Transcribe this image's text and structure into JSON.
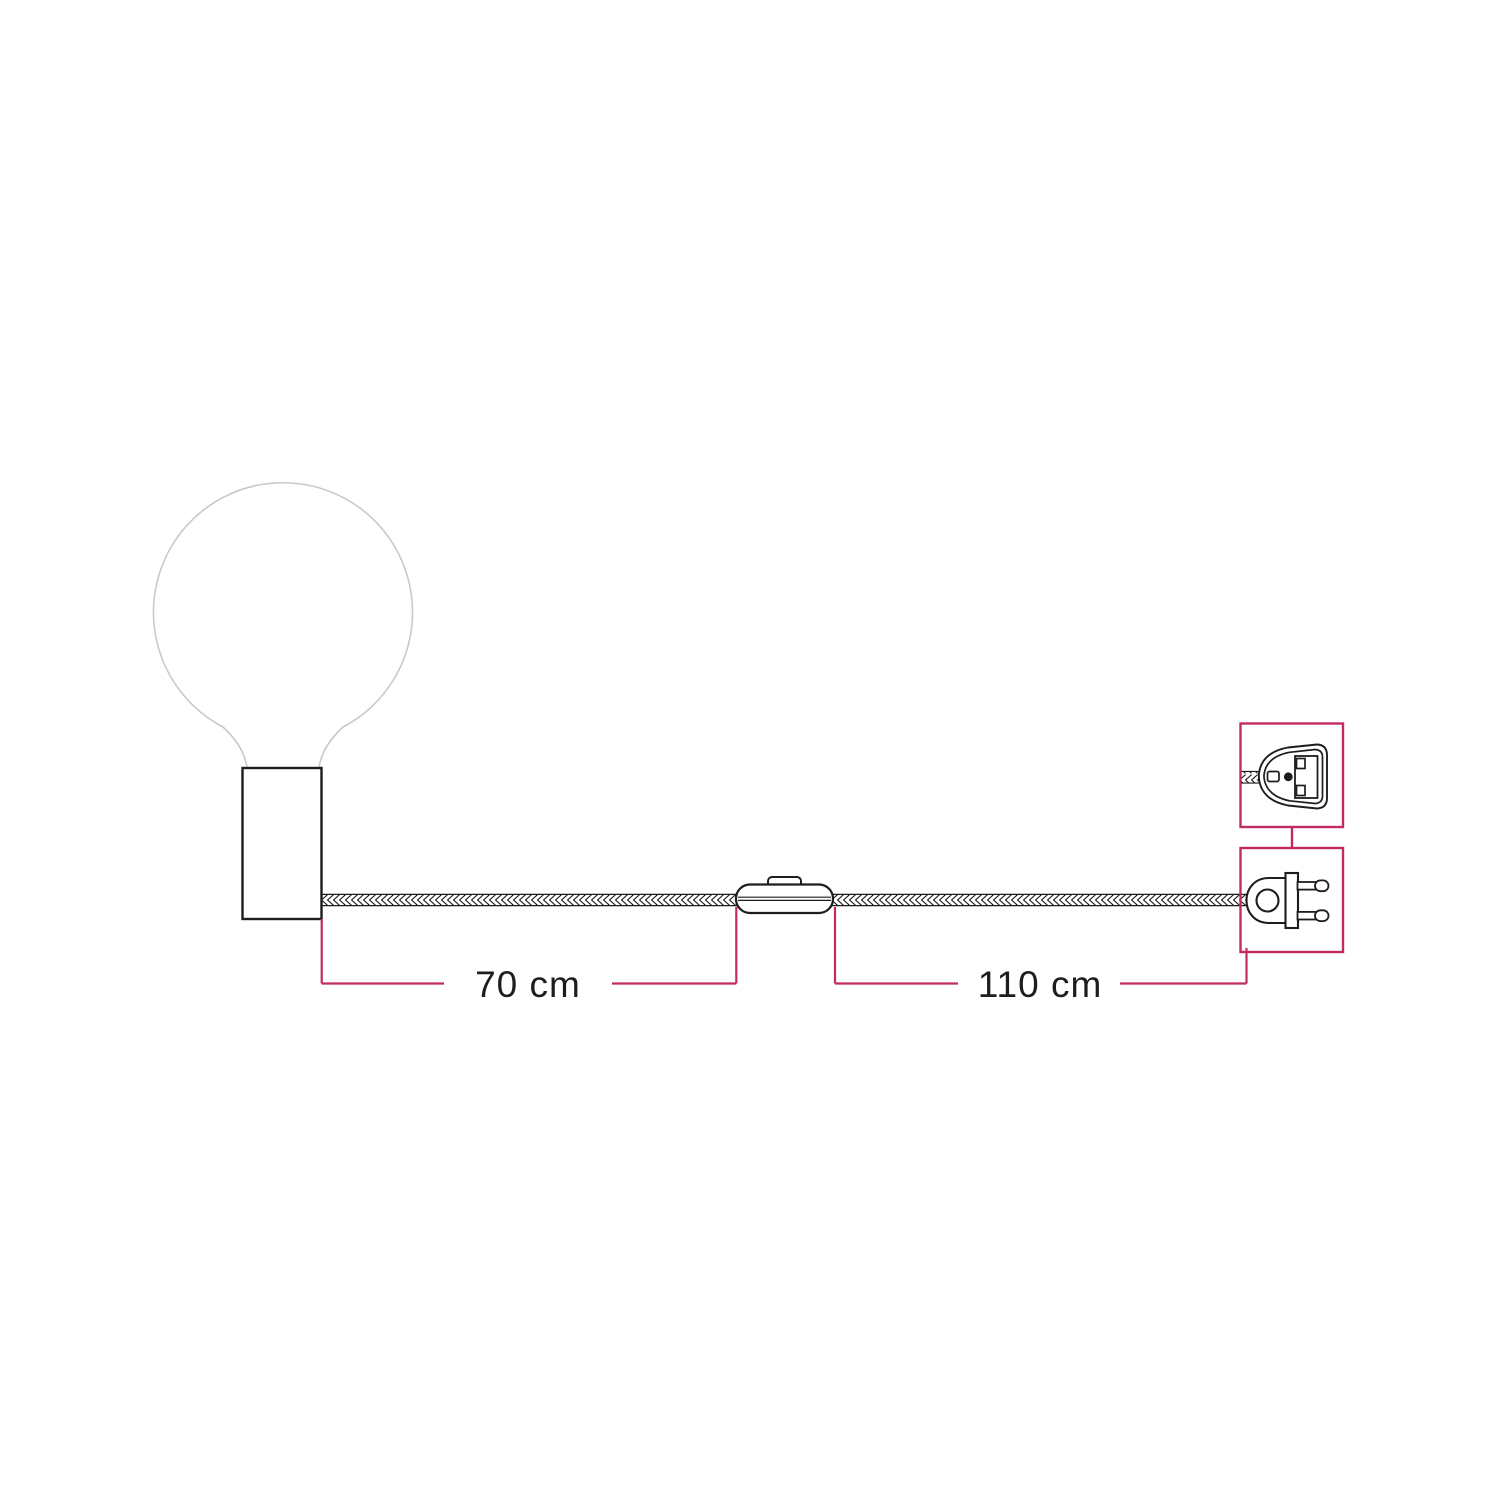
{
  "diagram": {
    "name": "lamp-cable-dimensions-diagram",
    "dimensions": {
      "holder_to_switch": {
        "label": "70 cm"
      },
      "switch_to_plug": {
        "label": "110 cm"
      }
    },
    "components": {
      "bulb": "globe-bulb",
      "holder": "cylindrical-lamp-holder",
      "cable": "braided-textile-cable",
      "switch": "inline-switch",
      "plug": "two-pin-europlug",
      "plug_detail": "uk-plug-adapter-face"
    },
    "colors": {
      "accent": "#c32a63",
      "line": "#1d1d1b",
      "bulb_outline": "#c9c9c9",
      "background": "#ffffff"
    }
  }
}
